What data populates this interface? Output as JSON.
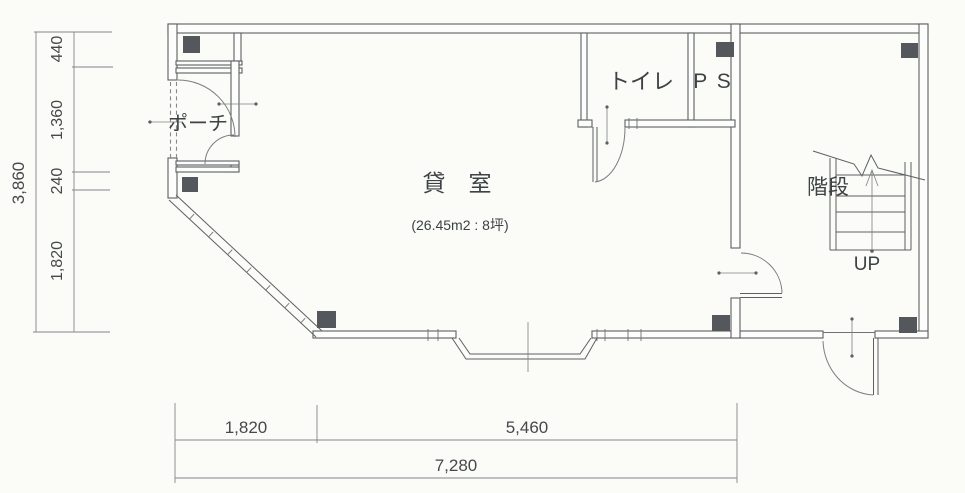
{
  "floor_plan": {
    "rooms": {
      "porch": {
        "label": "ポーチ"
      },
      "toilet": {
        "label": "トイレ"
      },
      "pipe_shaft": {
        "label": "P S"
      },
      "rental_room": {
        "label": "貸　室",
        "area": "(26.45m2 : 8坪)"
      },
      "staircase": {
        "label": "階段",
        "direction": "UP"
      }
    },
    "dimensions": {
      "left_total": "3,860",
      "left_segments": [
        "440",
        "1,360",
        "240",
        "1,820"
      ],
      "bottom_segments": [
        "1,820",
        "5,460"
      ],
      "bottom_total": "7,280"
    },
    "colors": {
      "background": "#fbfbf8",
      "wall_line": "#5c6063",
      "column_fill": "#54585c",
      "dim_line": "#83868a",
      "text": "#3d4245"
    }
  }
}
